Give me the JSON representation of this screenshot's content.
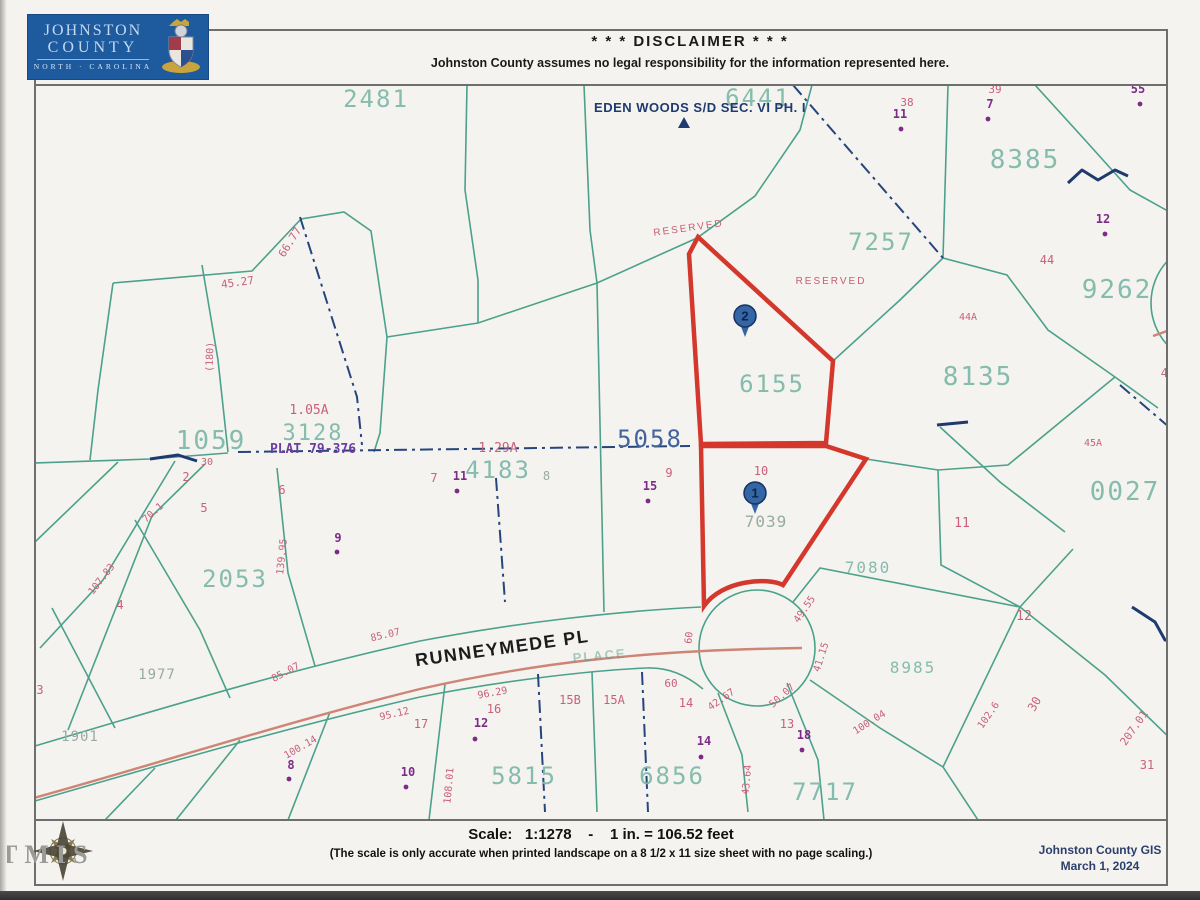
{
  "header": {
    "logo_line1": "JOHNSTON",
    "logo_line2": "COUNTY",
    "logo_line3": "NORTH · CAROLINA",
    "disclaimer_title": "* * *   DISCLAIMER   * * *",
    "disclaimer_body": "Johnston County assumes no legal responsibility for the information represented here."
  },
  "footer": {
    "scale_line": "Scale:   1:1278    -    1 in. = 106.52 feet",
    "scale_note": "(The scale is only accurate when printed landscape on a 8 1/2 x 11 size sheet with no page scaling.)",
    "credit_line1": "Johnston County GIS",
    "credit_line2": "March 1, 2024",
    "watermark": "TMIS"
  },
  "colors": {
    "parcel_line": "#4ba18c",
    "parcel_id": "#7cb8a8",
    "highlight": "#d4372b",
    "road_centerline": "#cf8576",
    "plat_dash": "#26457c",
    "lot_number": "#c9607a",
    "address_point": "#7c2b86",
    "logo_blue": "#1d5a9e"
  },
  "map": {
    "labels": [
      {
        "t": "2481",
        "x": 376,
        "y": 107,
        "c": "pid",
        "s": 24
      },
      {
        "t": "6441",
        "x": 758,
        "y": 106,
        "c": "pid",
        "s": 24
      },
      {
        "t": "7257",
        "x": 881,
        "y": 250,
        "c": "pid",
        "s": 24
      },
      {
        "t": "8385",
        "x": 1025,
        "y": 168,
        "c": "pid",
        "s": 26
      },
      {
        "t": "9262",
        "x": 1117,
        "y": 298,
        "c": "pid",
        "s": 26
      },
      {
        "t": "8135",
        "x": 978,
        "y": 385,
        "c": "pid",
        "s": 26
      },
      {
        "t": "0027",
        "x": 1125,
        "y": 500,
        "c": "pid",
        "s": 26
      },
      {
        "t": "6155",
        "x": 772,
        "y": 392,
        "c": "pid",
        "s": 24
      },
      {
        "t": "1059",
        "x": 211,
        "y": 449,
        "c": "pid",
        "s": 26
      },
      {
        "t": "3128",
        "x": 313,
        "y": 440,
        "c": "pid",
        "s": 22
      },
      {
        "t": "4183",
        "x": 498,
        "y": 478,
        "c": "pid",
        "s": 24
      },
      {
        "t": "2053",
        "x": 235,
        "y": 587,
        "c": "pid",
        "s": 24
      },
      {
        "t": "5815",
        "x": 524,
        "y": 784,
        "c": "pid",
        "s": 24
      },
      {
        "t": "6856",
        "x": 672,
        "y": 784,
        "c": "pid",
        "s": 24
      },
      {
        "t": "7717",
        "x": 825,
        "y": 800,
        "c": "pid",
        "s": 24
      },
      {
        "t": "7080",
        "x": 868,
        "y": 573,
        "c": "pid",
        "s": 16
      },
      {
        "t": "8985",
        "x": 913,
        "y": 673,
        "c": "pid",
        "s": 16
      },
      {
        "t": "7039",
        "x": 766,
        "y": 527,
        "c": "gray",
        "s": 16
      },
      {
        "t": "1977",
        "x": 157,
        "y": 679,
        "c": "gray",
        "s": 14
      },
      {
        "t": "1901",
        "x": 80,
        "y": 741,
        "c": "gray",
        "s": 14
      },
      {
        "t": "5058",
        "x": 650,
        "y": 447,
        "c": "pidnavy",
        "s": 24
      },
      {
        "t": "EDEN WOODS S/D SEC. VI PH. I",
        "x": 700,
        "y": 112,
        "c": "navylab",
        "s": 13,
        "n": "subdivision-label"
      },
      {
        "t": "RUNNEYMEDE PL",
        "x": 503,
        "y": 654,
        "c": "street",
        "s": 18,
        "r": -8,
        "n": "street-name-label"
      },
      {
        "t": "PLACE",
        "x": 600,
        "y": 660,
        "c": "ghost",
        "s": 13,
        "r": -5
      },
      {
        "t": "RESERVED",
        "x": 689,
        "y": 231,
        "c": "res",
        "s": 10,
        "r": -8
      },
      {
        "t": "RESERVED",
        "x": 831,
        "y": 284,
        "c": "res",
        "s": 10
      },
      {
        "t": "PLAT 79-376",
        "x": 313,
        "y": 453,
        "c": "plat",
        "s": 13
      },
      {
        "t": "1.05A",
        "x": 309,
        "y": 414,
        "c": "pk",
        "s": 13
      },
      {
        "t": "1.29A",
        "x": 498,
        "y": 452,
        "c": "pk",
        "s": 13
      },
      {
        "t": "38",
        "x": 907,
        "y": 106,
        "c": "pk",
        "s": 11
      },
      {
        "t": "39",
        "x": 995,
        "y": 93,
        "c": "pk",
        "s": 11
      },
      {
        "t": "44",
        "x": 1047,
        "y": 264,
        "c": "pk",
        "s": 12
      },
      {
        "t": "44A",
        "x": 968,
        "y": 320,
        "c": "pk",
        "s": 10
      },
      {
        "t": "45",
        "x": 1168,
        "y": 377,
        "c": "pk",
        "s": 12
      },
      {
        "t": "45A",
        "x": 1093,
        "y": 446,
        "c": "pk",
        "s": 10
      },
      {
        "t": "11",
        "x": 962,
        "y": 527,
        "c": "pk",
        "s": 13
      },
      {
        "t": "12",
        "x": 1024,
        "y": 620,
        "c": "pk",
        "s": 13
      },
      {
        "t": "2",
        "x": 186,
        "y": 481,
        "c": "pk",
        "s": 12
      },
      {
        "t": "30",
        "x": 207,
        "y": 465,
        "c": "pk",
        "s": 10
      },
      {
        "t": "5",
        "x": 204,
        "y": 512,
        "c": "pk",
        "s": 12
      },
      {
        "t": "6",
        "x": 282,
        "y": 494,
        "c": "pk",
        "s": 12
      },
      {
        "t": "7",
        "x": 434,
        "y": 482,
        "c": "pk",
        "s": 12
      },
      {
        "t": "8",
        "x": 547,
        "y": 480,
        "c": "gray",
        "s": 12
      },
      {
        "t": "9",
        "x": 669,
        "y": 477,
        "c": "pk",
        "s": 12
      },
      {
        "t": "10",
        "x": 761,
        "y": 475,
        "c": "pk",
        "s": 12
      },
      {
        "t": "3",
        "x": 40,
        "y": 694,
        "c": "pk",
        "s": 12
      },
      {
        "t": "4",
        "x": 120,
        "y": 609,
        "c": "pk",
        "s": 12
      },
      {
        "t": "17",
        "x": 421,
        "y": 728,
        "c": "pk",
        "s": 12
      },
      {
        "t": "16",
        "x": 494,
        "y": 713,
        "c": "pk",
        "s": 12
      },
      {
        "t": "15B",
        "x": 570,
        "y": 704,
        "c": "pk",
        "s": 12
      },
      {
        "t": "15A",
        "x": 614,
        "y": 704,
        "c": "pk",
        "s": 12
      },
      {
        "t": "60",
        "x": 671,
        "y": 687,
        "c": "pk",
        "s": 11
      },
      {
        "t": "14",
        "x": 686,
        "y": 707,
        "c": "pk",
        "s": 12
      },
      {
        "t": "13",
        "x": 787,
        "y": 728,
        "c": "pk",
        "s": 12
      },
      {
        "t": "31",
        "x": 1147,
        "y": 769,
        "c": "pk",
        "s": 12
      },
      {
        "t": "30",
        "x": 1038,
        "y": 706,
        "c": "pk",
        "s": 12,
        "r": -60
      },
      {
        "t": "45.27",
        "x": 238,
        "y": 286,
        "c": "dim",
        "s": 11,
        "r": -8
      },
      {
        "t": "66.77",
        "x": 293,
        "y": 244,
        "c": "dim",
        "s": 11,
        "r": -58
      },
      {
        "t": "(180)",
        "x": 213,
        "y": 357,
        "c": "dim",
        "s": 10,
        "r": -88
      },
      {
        "t": "70.1",
        "x": 155,
        "y": 515,
        "c": "dim",
        "s": 10,
        "r": -42
      },
      {
        "t": "107.83",
        "x": 104,
        "y": 581,
        "c": "dim",
        "s": 10,
        "r": -52
      },
      {
        "t": "105",
        "x": 33,
        "y": 657,
        "c": "dim",
        "s": 10,
        "r": -62
      },
      {
        "t": "139.95",
        "x": 285,
        "y": 557,
        "c": "dim",
        "s": 10,
        "r": -84
      },
      {
        "t": "85.07",
        "x": 386,
        "y": 638,
        "c": "dim",
        "s": 10,
        "r": -13
      },
      {
        "t": "85.07",
        "x": 287,
        "y": 675,
        "c": "dim",
        "s": 10,
        "r": -28
      },
      {
        "t": "95.12",
        "x": 395,
        "y": 717,
        "c": "dim",
        "s": 10,
        "r": -13
      },
      {
        "t": "96.29",
        "x": 493,
        "y": 696,
        "c": "dim",
        "s": 10,
        "r": -10
      },
      {
        "t": "100.14",
        "x": 302,
        "y": 750,
        "c": "dim",
        "s": 10,
        "r": -30
      },
      {
        "t": "42.67",
        "x": 723,
        "y": 702,
        "c": "dim",
        "s": 10,
        "r": -35
      },
      {
        "t": "50.07",
        "x": 784,
        "y": 698,
        "c": "dim",
        "s": 10,
        "r": -42
      },
      {
        "t": "41.15",
        "x": 824,
        "y": 658,
        "c": "dim",
        "s": 10,
        "r": -72
      },
      {
        "t": "49.55",
        "x": 807,
        "y": 611,
        "c": "dim",
        "s": 10,
        "r": -55
      },
      {
        "t": "60",
        "x": 692,
        "y": 638,
        "c": "dim",
        "s": 10,
        "r": -84
      },
      {
        "t": "43.64",
        "x": 750,
        "y": 780,
        "c": "dim",
        "s": 10,
        "r": -85
      },
      {
        "t": "100.04",
        "x": 871,
        "y": 725,
        "c": "dim",
        "s": 10,
        "r": -32
      },
      {
        "t": "102.6",
        "x": 991,
        "y": 717,
        "c": "dim",
        "s": 10,
        "r": -55
      },
      {
        "t": "207.01",
        "x": 1137,
        "y": 730,
        "c": "dim",
        "s": 11,
        "r": -55
      },
      {
        "t": "108.01",
        "x": 452,
        "y": 786,
        "c": "dim",
        "s": 10,
        "r": -85
      },
      {
        "t": "11",
        "x": 900,
        "y": 118,
        "c": "ad",
        "s": 12
      },
      {
        "t": "7",
        "x": 990,
        "y": 108,
        "c": "ad",
        "s": 12
      },
      {
        "t": "55",
        "x": 1138,
        "y": 93,
        "c": "ad",
        "s": 12
      },
      {
        "t": "12",
        "x": 1103,
        "y": 223,
        "c": "ad",
        "s": 12
      },
      {
        "t": "11",
        "x": 460,
        "y": 480,
        "c": "ad",
        "s": 12
      },
      {
        "t": "15",
        "x": 650,
        "y": 490,
        "c": "ad",
        "s": 12
      },
      {
        "t": "9",
        "x": 338,
        "y": 542,
        "c": "ad",
        "s": 12
      },
      {
        "t": "12",
        "x": 481,
        "y": 727,
        "c": "ad",
        "s": 12
      },
      {
        "t": "8",
        "x": 291,
        "y": 769,
        "c": "ad",
        "s": 12
      },
      {
        "t": "10",
        "x": 408,
        "y": 776,
        "c": "ad",
        "s": 12
      },
      {
        "t": "14",
        "x": 704,
        "y": 745,
        "c": "ad",
        "s": 12
      },
      {
        "t": "18",
        "x": 804,
        "y": 739,
        "c": "ad",
        "s": 12
      }
    ],
    "address_dots": [
      {
        "x": 901,
        "y": 129
      },
      {
        "x": 988,
        "y": 119
      },
      {
        "x": 1140,
        "y": 104
      },
      {
        "x": 1105,
        "y": 234
      },
      {
        "x": 457,
        "y": 491
      },
      {
        "x": 648,
        "y": 501
      },
      {
        "x": 337,
        "y": 552
      },
      {
        "x": 475,
        "y": 739
      },
      {
        "x": 289,
        "y": 779
      },
      {
        "x": 406,
        "y": 787
      },
      {
        "x": 701,
        "y": 757
      },
      {
        "x": 802,
        "y": 750
      }
    ],
    "pins": [
      {
        "label": "1",
        "x": 755,
        "y": 493
      },
      {
        "label": "2",
        "x": 745,
        "y": 316
      }
    ]
  }
}
